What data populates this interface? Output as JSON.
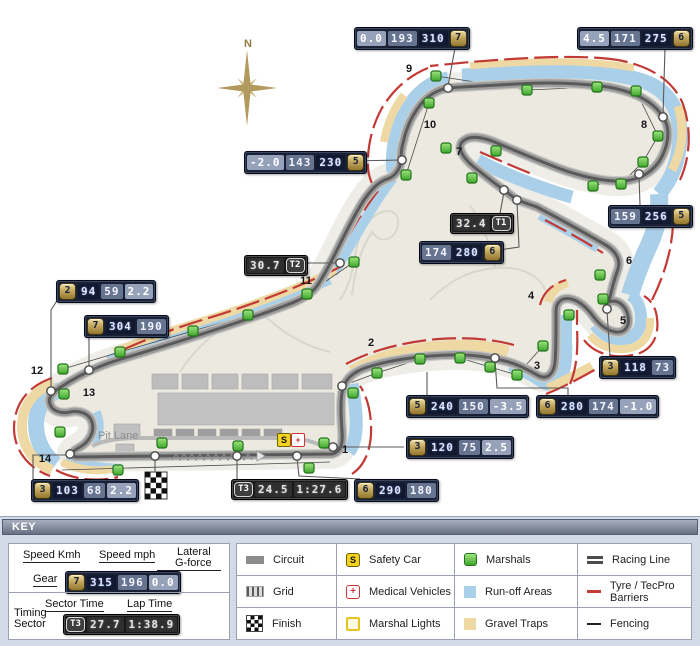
{
  "map": {
    "compass_label": "N",
    "pit_lane_label": "Pit Lane",
    "safety_car_letter": "S",
    "medical_cross": "+",
    "turns": [
      {
        "n": "1",
        "x": 345,
        "y": 450
      },
      {
        "n": "2",
        "x": 371,
        "y": 343
      },
      {
        "n": "3",
        "x": 537,
        "y": 366
      },
      {
        "n": "4",
        "x": 531,
        "y": 296
      },
      {
        "n": "5",
        "x": 623,
        "y": 321
      },
      {
        "n": "6",
        "x": 629,
        "y": 261
      },
      {
        "n": "7",
        "x": 459,
        "y": 152
      },
      {
        "n": "8",
        "x": 644,
        "y": 125
      },
      {
        "n": "9",
        "x": 409,
        "y": 69
      },
      {
        "n": "10",
        "x": 430,
        "y": 125
      },
      {
        "n": "11",
        "x": 306,
        "y": 281
      },
      {
        "n": "12",
        "x": 37,
        "y": 371
      },
      {
        "n": "13",
        "x": 89,
        "y": 393
      },
      {
        "n": "14",
        "x": 45,
        "y": 459
      }
    ],
    "boxes": [
      {
        "id": "turn9",
        "x": 354,
        "y": 27,
        "kind": "speed",
        "badge": "7",
        "badge_side": "right",
        "cells": [
          {
            "v": "0.0",
            "tone": "tlight"
          },
          {
            "v": "193",
            "tone": "tmed"
          },
          {
            "v": "310",
            "tone": "tdark"
          }
        ]
      },
      {
        "id": "turn8",
        "x": 577,
        "y": 27,
        "kind": "speed",
        "badge": "6",
        "badge_side": "right",
        "cells": [
          {
            "v": "4.5",
            "tone": "tlight"
          },
          {
            "v": "171",
            "tone": "tmed"
          },
          {
            "v": "275",
            "tone": "tdark"
          }
        ]
      },
      {
        "id": "turn10",
        "x": 244,
        "y": 151,
        "kind": "speed",
        "badge": "5",
        "badge_side": "right",
        "cells": [
          {
            "v": "-2.0",
            "tone": "tlight"
          },
          {
            "v": "143",
            "tone": "tmed"
          },
          {
            "v": "230",
            "tone": "tdark"
          }
        ]
      },
      {
        "id": "sector1",
        "x": 450,
        "y": 213,
        "kind": "timing",
        "badge": "T1",
        "badge_side": "right",
        "cells": [
          {
            "v": "32.4",
            "tone": "ttime"
          }
        ]
      },
      {
        "id": "turn7",
        "x": 419,
        "y": 241,
        "kind": "speed",
        "badge": "6",
        "badge_side": "right",
        "cells": [
          {
            "v": "174",
            "tone": "tmed"
          },
          {
            "v": "280",
            "tone": "tdark"
          }
        ]
      },
      {
        "id": "turn8exit",
        "x": 608,
        "y": 205,
        "kind": "speed",
        "badge": "5",
        "badge_side": "right",
        "cells": [
          {
            "v": "159",
            "tone": "tmed"
          },
          {
            "v": "256",
            "tone": "tdark"
          }
        ]
      },
      {
        "id": "sector2",
        "x": 244,
        "y": 255,
        "kind": "timing",
        "badge": "T2",
        "badge_side": "right",
        "cells": [
          {
            "v": "30.7",
            "tone": "ttime"
          }
        ]
      },
      {
        "id": "turn12",
        "x": 56,
        "y": 280,
        "kind": "speed",
        "badge": "2",
        "badge_side": "left",
        "cells": [
          {
            "v": "94",
            "tone": "tdark"
          },
          {
            "v": "59",
            "tone": "tmed"
          },
          {
            "v": "2.2",
            "tone": "tlight"
          }
        ]
      },
      {
        "id": "turn11",
        "x": 84,
        "y": 315,
        "kind": "speed",
        "badge": "7",
        "badge_side": "left",
        "cells": [
          {
            "v": "304",
            "tone": "tdark"
          },
          {
            "v": "190",
            "tone": "tmed"
          }
        ]
      },
      {
        "id": "turn5",
        "x": 599,
        "y": 356,
        "kind": "speed",
        "badge": "3",
        "badge_side": "left",
        "cells": [
          {
            "v": "118",
            "tone": "tdark"
          },
          {
            "v": "73",
            "tone": "tmed"
          }
        ]
      },
      {
        "id": "turn2",
        "x": 406,
        "y": 395,
        "kind": "speed",
        "badge": "5",
        "badge_side": "left",
        "cells": [
          {
            "v": "240",
            "tone": "tdark"
          },
          {
            "v": "150",
            "tone": "tmed"
          },
          {
            "v": "-3.5",
            "tone": "tlight"
          }
        ]
      },
      {
        "id": "turn3",
        "x": 536,
        "y": 395,
        "kind": "speed",
        "badge": "6",
        "badge_side": "left",
        "cells": [
          {
            "v": "280",
            "tone": "tdark"
          },
          {
            "v": "174",
            "tone": "tmed"
          },
          {
            "v": "-1.0",
            "tone": "tlight"
          }
        ]
      },
      {
        "id": "turn1",
        "x": 406,
        "y": 436,
        "kind": "speed",
        "badge": "3",
        "badge_side": "left",
        "cells": [
          {
            "v": "120",
            "tone": "tdark"
          },
          {
            "v": "75",
            "tone": "tmed"
          },
          {
            "v": "2.5",
            "tone": "tlight"
          }
        ]
      },
      {
        "id": "turn14",
        "x": 31,
        "y": 479,
        "kind": "speed",
        "badge": "3",
        "badge_side": "left",
        "cells": [
          {
            "v": "103",
            "tone": "tdark"
          },
          {
            "v": "68",
            "tone": "tmed"
          },
          {
            "v": "2.2",
            "tone": "tlight"
          }
        ]
      },
      {
        "id": "sector3",
        "x": 231,
        "y": 479,
        "kind": "timing",
        "badge": "T3",
        "badge_side": "left",
        "cells": [
          {
            "v": "24.5",
            "tone": "ttime"
          },
          {
            "v": "1:27.6",
            "tone": "ttime"
          }
        ]
      },
      {
        "id": "startfinish",
        "x": 354,
        "y": 479,
        "kind": "speed",
        "badge": "6",
        "badge_side": "left",
        "cells": [
          {
            "v": "290",
            "tone": "tdark"
          },
          {
            "v": "180",
            "tone": "tmed"
          }
        ]
      }
    ],
    "marshals": [
      [
        436,
        76
      ],
      [
        527,
        90
      ],
      [
        597,
        87
      ],
      [
        636,
        91
      ],
      [
        658,
        136
      ],
      [
        643,
        162
      ],
      [
        621,
        184
      ],
      [
        429,
        103
      ],
      [
        446,
        148
      ],
      [
        496,
        151
      ],
      [
        472,
        178
      ],
      [
        406,
        175
      ],
      [
        593,
        186
      ],
      [
        600,
        275
      ],
      [
        603,
        299
      ],
      [
        569,
        315
      ],
      [
        543,
        346
      ],
      [
        517,
        375
      ],
      [
        490,
        367
      ],
      [
        460,
        358
      ],
      [
        420,
        359
      ],
      [
        377,
        373
      ],
      [
        353,
        393
      ],
      [
        354,
        262
      ],
      [
        307,
        294
      ],
      [
        248,
        315
      ],
      [
        193,
        331
      ],
      [
        120,
        352
      ],
      [
        63,
        369
      ],
      [
        64,
        394
      ],
      [
        60,
        432
      ],
      [
        118,
        470
      ],
      [
        162,
        443
      ],
      [
        238,
        446
      ],
      [
        324,
        443
      ],
      [
        309,
        468
      ]
    ],
    "dots": [
      [
        448,
        88
      ],
      [
        663,
        117
      ],
      [
        402,
        160
      ],
      [
        504,
        190
      ],
      [
        517,
        200
      ],
      [
        639,
        174
      ],
      [
        340,
        263
      ],
      [
        89,
        370
      ],
      [
        51,
        391
      ],
      [
        70,
        454
      ],
      [
        155,
        456
      ],
      [
        237,
        456
      ],
      [
        297,
        456
      ],
      [
        333,
        447
      ],
      [
        342,
        386
      ],
      [
        495,
        358
      ],
      [
        607,
        309
      ]
    ]
  },
  "key": {
    "title": "KEY",
    "speed_legend": {
      "kmh_label": "Speed Kmh",
      "mph_label": "Speed mph",
      "lateral_line1": "Lateral",
      "lateral_line2": "G-force",
      "gear_label": "Gear",
      "sample": {
        "gear": "7",
        "kmh": "315",
        "mph": "196",
        "g": "0.0"
      }
    },
    "timing_legend": {
      "sector_label": "Sector Time",
      "lap_label": "Lap Time",
      "timing_line1": "Timing",
      "timing_line2": "Sector",
      "sample": {
        "badge": "T3",
        "sector": "27.7",
        "lap": "1:38.9"
      }
    },
    "items": [
      {
        "icon": "circuit",
        "label": "Circuit"
      },
      {
        "icon": "safety-car",
        "label": "Safety Car"
      },
      {
        "icon": "marshals",
        "label": "Marshals"
      },
      {
        "icon": "racing-line",
        "label": "Racing Line"
      },
      {
        "icon": "grid",
        "label": "Grid"
      },
      {
        "icon": "medical",
        "label": "Medical Vehicles"
      },
      {
        "icon": "runoff",
        "label": "Run-off Areas"
      },
      {
        "icon": "tyre-barriers",
        "label": "Tyre / TecPro Barriers"
      },
      {
        "icon": "finish",
        "label": "Finish"
      },
      {
        "icon": "marshal-lights",
        "label": "Marshal Lights"
      },
      {
        "icon": "gravel",
        "label": "Gravel Traps"
      },
      {
        "icon": "fencing",
        "label": "Fencing"
      }
    ]
  },
  "colors": {
    "box_navy": "#1a2136",
    "cell_dark": "#10192f",
    "cell_med": "#67748f",
    "cell_light": "#96a1ba",
    "gear_gold": "#c2a75e",
    "runoff_blue": "#a9cfe9",
    "gravel_tan": "#eed9a4",
    "barrier_red": "#c23a36",
    "marshal_green": "#5ec24a",
    "track_gray": "#9c9c9c",
    "racing_line": "#5a5a5a",
    "key_bg": "#d2dbe7"
  }
}
